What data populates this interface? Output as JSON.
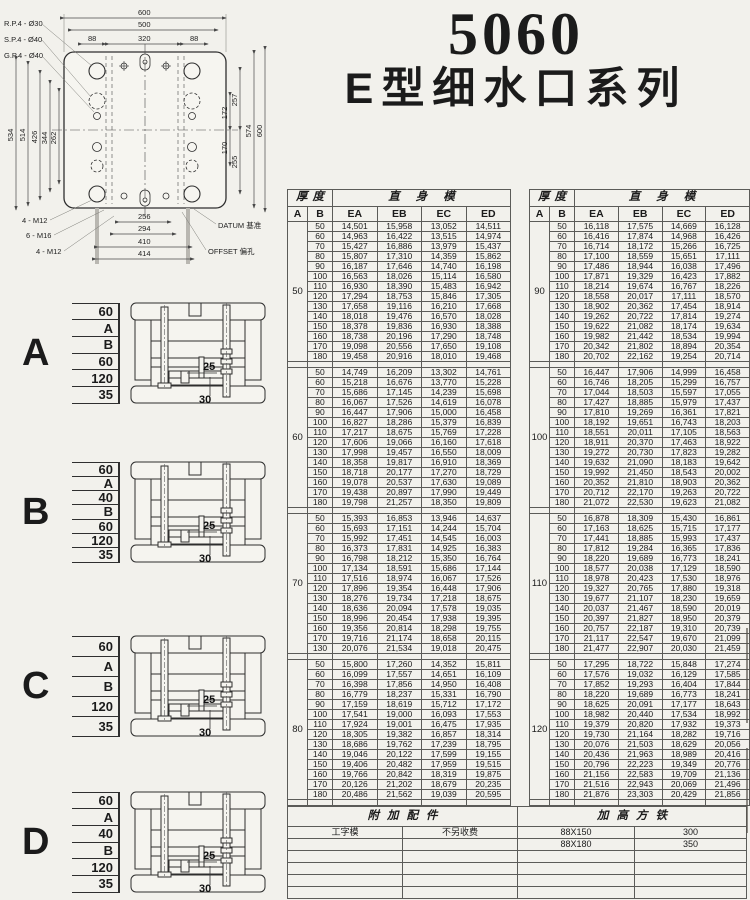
{
  "title": {
    "code": "5060",
    "series": "E型细水口系列"
  },
  "drawing": {
    "hole_labels": [
      "R.P.4 - Ø30",
      "S.P.4 - Ø40",
      "G.P.4 - Ø40"
    ],
    "top_dims": [
      "600",
      "500",
      "320",
      "88",
      "88"
    ],
    "left_dims": [
      "534",
      "514",
      "426",
      "344",
      "262"
    ],
    "right_dims": [
      "257",
      "172",
      "170",
      "255",
      "574",
      "600"
    ],
    "bottom_dims": [
      "256",
      "294",
      "410",
      "414"
    ],
    "thread_labels": [
      "4 - M12",
      "6 - M16",
      "4 - M12"
    ],
    "datum": "DATUM 基准",
    "offset": "OFFSET 偏孔"
  },
  "diagrams": [
    {
      "label": "A",
      "dims": [
        "60",
        "A",
        "B",
        "60",
        "120",
        "35"
      ],
      "inner_dims": [
        "25",
        "30"
      ]
    },
    {
      "label": "B",
      "dims": [
        "60",
        "A",
        "40",
        "B",
        "60",
        "120",
        "35"
      ],
      "inner_dims": [
        "25",
        "30"
      ]
    },
    {
      "label": "C",
      "dims": [
        "60",
        "A",
        "B",
        "120",
        "35"
      ],
      "inner_dims": [
        "25",
        "30"
      ]
    },
    {
      "label": "D",
      "dims": [
        "60",
        "A",
        "40",
        "B",
        "120",
        "35"
      ],
      "inner_dims": [
        "25",
        "30"
      ]
    }
  ],
  "tables": {
    "header": {
      "thickness": "厚度",
      "straight_body": "直身模",
      "sub": [
        "A",
        "B",
        "EA",
        "EB",
        "EC",
        "ED"
      ]
    },
    "left_blocks": [
      {
        "a": "50",
        "rows": [
          [
            "50",
            "14,501",
            "15,958",
            "13,052",
            "14,511"
          ],
          [
            "60",
            "14,963",
            "16,422",
            "13,515",
            "14,974"
          ],
          [
            "70",
            "15,427",
            "16,886",
            "13,979",
            "15,437"
          ],
          [
            "80",
            "15,807",
            "17,310",
            "14,359",
            "15,862"
          ],
          [
            "90",
            "16,187",
            "17,646",
            "14,740",
            "16,198"
          ],
          [
            "100",
            "16,563",
            "18,026",
            "15,114",
            "16,580"
          ],
          [
            "110",
            "16,930",
            "18,390",
            "15,483",
            "16,942"
          ],
          [
            "120",
            "17,294",
            "18,753",
            "15,846",
            "17,305"
          ],
          [
            "130",
            "17,658",
            "19,116",
            "16,210",
            "17,668"
          ],
          [
            "140",
            "18,018",
            "19,476",
            "16,570",
            "18,028"
          ],
          [
            "150",
            "18,378",
            "19,836",
            "16,930",
            "18,388"
          ],
          [
            "160",
            "18,738",
            "20,196",
            "17,290",
            "18,748"
          ],
          [
            "170",
            "19,098",
            "20,556",
            "17,650",
            "19,108"
          ],
          [
            "180",
            "19,458",
            "20,916",
            "18,010",
            "19,468"
          ]
        ]
      },
      {
        "a": "60",
        "rows": [
          [
            "50",
            "14,749",
            "16,209",
            "13,302",
            "14,761"
          ],
          [
            "60",
            "15,218",
            "16,676",
            "13,770",
            "15,228"
          ],
          [
            "70",
            "15,686",
            "17,145",
            "14,239",
            "15,698"
          ],
          [
            "80",
            "16,067",
            "17,526",
            "14,619",
            "16,078"
          ],
          [
            "90",
            "16,447",
            "17,906",
            "15,000",
            "16,458"
          ],
          [
            "100",
            "16,827",
            "18,286",
            "15,379",
            "16,839"
          ],
          [
            "110",
            "17,217",
            "18,675",
            "15,769",
            "17,228"
          ],
          [
            "120",
            "17,606",
            "19,066",
            "16,160",
            "17,618"
          ],
          [
            "130",
            "17,998",
            "19,457",
            "16,550",
            "18,009"
          ],
          [
            "140",
            "18,358",
            "19,817",
            "16,910",
            "18,369"
          ],
          [
            "150",
            "18,718",
            "20,177",
            "17,270",
            "18,729"
          ],
          [
            "160",
            "19,078",
            "20,537",
            "17,630",
            "19,089"
          ],
          [
            "170",
            "19,438",
            "20,897",
            "17,990",
            "19,449"
          ],
          [
            "180",
            "19,798",
            "21,257",
            "18,350",
            "19,809"
          ]
        ]
      },
      {
        "a": "70",
        "rows": [
          [
            "50",
            "15,393",
            "16,853",
            "13,946",
            "14,637"
          ],
          [
            "60",
            "15,693",
            "17,151",
            "14,244",
            "15,704"
          ],
          [
            "70",
            "15,992",
            "17,451",
            "14,545",
            "16,003"
          ],
          [
            "80",
            "16,373",
            "17,831",
            "14,925",
            "16,383"
          ],
          [
            "90",
            "16,798",
            "18,212",
            "15,350",
            "16,764"
          ],
          [
            "100",
            "17,134",
            "18,591",
            "15,686",
            "17,144"
          ],
          [
            "110",
            "17,516",
            "18,974",
            "16,067",
            "17,526"
          ],
          [
            "120",
            "17,896",
            "19,354",
            "16,448",
            "17,906"
          ],
          [
            "130",
            "18,276",
            "19,734",
            "17,218",
            "18,675"
          ],
          [
            "140",
            "18,636",
            "20,094",
            "17,578",
            "19,035"
          ],
          [
            "150",
            "18,996",
            "20,454",
            "17,938",
            "19,395"
          ],
          [
            "160",
            "19,356",
            "20,814",
            "18,298",
            "19,755"
          ],
          [
            "170",
            "19,716",
            "21,174",
            "18,658",
            "20,115"
          ],
          [
            "130",
            "20,076",
            "21,534",
            "19,018",
            "20,475"
          ]
        ]
      },
      {
        "a": "80",
        "rows": [
          [
            "50",
            "15,800",
            "17,260",
            "14,352",
            "15,811"
          ],
          [
            "60",
            "16,099",
            "17,557",
            "14,651",
            "16,109"
          ],
          [
            "70",
            "16,398",
            "17,856",
            "14,950",
            "16,408"
          ],
          [
            "80",
            "16,779",
            "18,237",
            "15,331",
            "16,790"
          ],
          [
            "90",
            "17,159",
            "18,619",
            "15,712",
            "17,172"
          ],
          [
            "100",
            "17,541",
            "19,000",
            "16,093",
            "17,553"
          ],
          [
            "110",
            "17,924",
            "19,001",
            "16,475",
            "17,935"
          ],
          [
            "120",
            "18,305",
            "19,382",
            "16,857",
            "18,314"
          ],
          [
            "130",
            "18,686",
            "19,762",
            "17,239",
            "18,795"
          ],
          [
            "140",
            "19,046",
            "20,122",
            "17,599",
            "19,155"
          ],
          [
            "150",
            "19,406",
            "20,482",
            "17,959",
            "19,515"
          ],
          [
            "160",
            "19,766",
            "20,842",
            "18,319",
            "19,875"
          ],
          [
            "170",
            "20,126",
            "21,202",
            "18,679",
            "20,235"
          ],
          [
            "180",
            "20,486",
            "21,562",
            "19,039",
            "20,595"
          ]
        ]
      }
    ],
    "right_blocks": [
      {
        "a": "90",
        "rows": [
          [
            "50",
            "16,118",
            "17,575",
            "14,669",
            "16,128"
          ],
          [
            "60",
            "16,416",
            "17,874",
            "14,968",
            "16,426"
          ],
          [
            "70",
            "16,714",
            "18,172",
            "15,266",
            "16,725"
          ],
          [
            "80",
            "17,100",
            "18,559",
            "15,651",
            "17,111"
          ],
          [
            "90",
            "17,486",
            "18,944",
            "16,038",
            "17,496"
          ],
          [
            "100",
            "17,871",
            "19,329",
            "16,423",
            "17,882"
          ],
          [
            "110",
            "18,214",
            "19,674",
            "16,767",
            "18,226"
          ],
          [
            "120",
            "18,558",
            "20,017",
            "17,111",
            "18,570"
          ],
          [
            "130",
            "18,902",
            "20,362",
            "17,454",
            "18,914"
          ],
          [
            "140",
            "19,262",
            "20,722",
            "17,814",
            "19,274"
          ],
          [
            "150",
            "19,622",
            "21,082",
            "18,174",
            "19,634"
          ],
          [
            "160",
            "19,982",
            "21,442",
            "18,534",
            "19,994"
          ],
          [
            "170",
            "20,342",
            "21,802",
            "18,894",
            "20,354"
          ],
          [
            "180",
            "20,702",
            "22,162",
            "19,254",
            "20,714"
          ]
        ]
      },
      {
        "a": "100",
        "rows": [
          [
            "50",
            "16,447",
            "17,906",
            "14,999",
            "16,458"
          ],
          [
            "60",
            "16,746",
            "18,205",
            "15,299",
            "16,757"
          ],
          [
            "70",
            "17,044",
            "18,503",
            "15,597",
            "17,055"
          ],
          [
            "80",
            "17,427",
            "18,885",
            "15,979",
            "17,437"
          ],
          [
            "90",
            "17,810",
            "19,269",
            "16,361",
            "17,821"
          ],
          [
            "100",
            "18,192",
            "19,651",
            "16,743",
            "18,203"
          ],
          [
            "110",
            "18,551",
            "20,011",
            "17,105",
            "18,563"
          ],
          [
            "120",
            "18,911",
            "20,370",
            "17,463",
            "18,922"
          ],
          [
            "130",
            "19,272",
            "20,730",
            "17,823",
            "19,282"
          ],
          [
            "140",
            "19,632",
            "21,090",
            "18,183",
            "19,642"
          ],
          [
            "150",
            "19,992",
            "21,450",
            "18,543",
            "20,002"
          ],
          [
            "160",
            "20,352",
            "21,810",
            "18,903",
            "20,362"
          ],
          [
            "170",
            "20,712",
            "22,170",
            "19,263",
            "20,722"
          ],
          [
            "180",
            "21,072",
            "22,530",
            "19,623",
            "21,082"
          ]
        ]
      },
      {
        "a": "110",
        "rows": [
          [
            "50",
            "16,878",
            "18,309",
            "15,430",
            "16,861"
          ],
          [
            "60",
            "17,163",
            "18,625",
            "15,715",
            "17,177"
          ],
          [
            "70",
            "17,441",
            "18,885",
            "15,993",
            "17,437"
          ],
          [
            "80",
            "17,812",
            "19,284",
            "16,365",
            "17,836"
          ],
          [
            "90",
            "18,220",
            "19,689",
            "16,773",
            "18,241"
          ],
          [
            "100",
            "18,577",
            "20,038",
            "17,129",
            "18,590"
          ],
          [
            "110",
            "18,978",
            "20,423",
            "17,530",
            "18,976"
          ],
          [
            "120",
            "19,327",
            "20,765",
            "17,880",
            "19,318"
          ],
          [
            "130",
            "19,677",
            "21,107",
            "18,230",
            "19,659"
          ],
          [
            "140",
            "20,037",
            "21,467",
            "18,590",
            "20,019"
          ],
          [
            "150",
            "20,397",
            "21,827",
            "18,950",
            "20,379"
          ],
          [
            "160",
            "20,757",
            "22,187",
            "19,310",
            "20,739"
          ],
          [
            "170",
            "21,117",
            "22,547",
            "19,670",
            "21,099"
          ],
          [
            "180",
            "21,477",
            "22,907",
            "20,030",
            "21,459"
          ]
        ]
      },
      {
        "a": "120",
        "rows": [
          [
            "50",
            "17,295",
            "18,722",
            "15,848",
            "17,274"
          ],
          [
            "60",
            "17,576",
            "19,032",
            "16,129",
            "17,585"
          ],
          [
            "70",
            "17,852",
            "19,293",
            "16,404",
            "17,844"
          ],
          [
            "80",
            "18,220",
            "19,689",
            "16,773",
            "18,241"
          ],
          [
            "90",
            "18,625",
            "20,091",
            "17,177",
            "18,643"
          ],
          [
            "100",
            "18,982",
            "20,440",
            "17,534",
            "18,992"
          ],
          [
            "110",
            "19,379",
            "20,820",
            "17,932",
            "19,373"
          ],
          [
            "120",
            "19,730",
            "21,164",
            "18,282",
            "19,716"
          ],
          [
            "130",
            "20,076",
            "21,503",
            "18,629",
            "20,056"
          ],
          [
            "140",
            "20,436",
            "21,963",
            "18,989",
            "20,416"
          ],
          [
            "150",
            "20,796",
            "22,223",
            "19,349",
            "20,776"
          ],
          [
            "160",
            "21,156",
            "22,583",
            "19,709",
            "21,136"
          ],
          [
            "170",
            "21,516",
            "22,943",
            "20,069",
            "21,496"
          ],
          [
            "180",
            "21,876",
            "23,303",
            "20,429",
            "21,856"
          ]
        ]
      }
    ]
  },
  "accessories": {
    "header_left": "附加配件",
    "header_right": "加高方铁",
    "rows": [
      [
        "工字模",
        "不另收费",
        "88X150",
        "300"
      ],
      [
        "",
        "",
        "88X180",
        "350"
      ],
      [
        "",
        "",
        "",
        ""
      ],
      [
        "",
        "",
        "",
        ""
      ],
      [
        "",
        "",
        "",
        ""
      ],
      [
        "",
        "",
        "",
        ""
      ]
    ]
  }
}
